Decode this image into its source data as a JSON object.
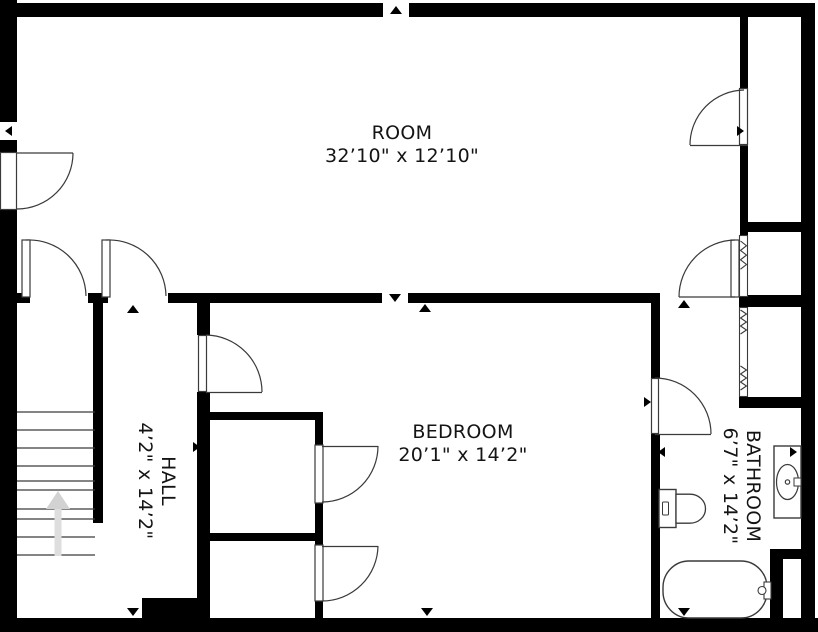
{
  "plan": {
    "type": "floor-plan",
    "rooms": [
      {
        "id": "room",
        "name": "ROOM",
        "dimensions": "32’10\" x 12’10\""
      },
      {
        "id": "bedroom",
        "name": "BEDROOM",
        "dimensions": "20’1\" x 14’2\""
      },
      {
        "id": "hall",
        "name": "HALL",
        "dimensions": "4’2\" x 14’2\""
      },
      {
        "id": "bathroom",
        "name": "BATHROOM",
        "dimensions": "6’7\" x 14’2\""
      }
    ],
    "fixtures": [
      "stairs",
      "stairs-direction-arrow",
      "toilet",
      "sink-vanity",
      "bathtub",
      "swing-doors",
      "bifold-closet-doors"
    ],
    "colors": {
      "wall": "#000000",
      "floor": "#ffffff",
      "line": "#3a3a3a",
      "stairs_arrow": "#d2d2d2",
      "text": "#141414"
    }
  }
}
